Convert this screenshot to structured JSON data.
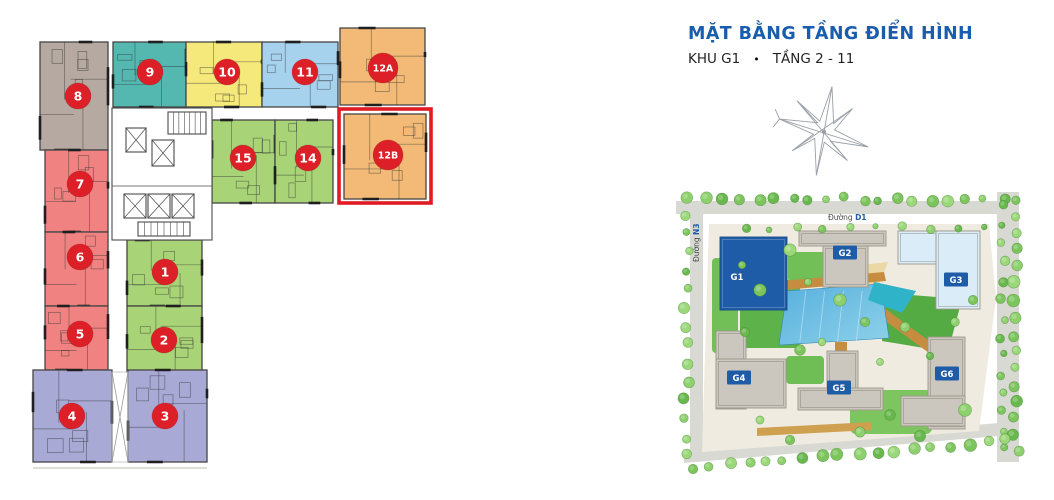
{
  "header": {
    "title": "MẶT BẰNG TẦNG ĐIỂN HÌNH",
    "subtitle_block": "KHU G1",
    "subtitle_bullet": "•",
    "subtitle_floors": "TẦNG 2 - 11",
    "title_color": "#1a5dad"
  },
  "floor_plan": {
    "badge_color": "#dd2027",
    "badge_text_color": "#ffffff",
    "wall_color": "#454545",
    "highlight": {
      "unit": "12B",
      "color": "#e01b23",
      "x": 339,
      "y": 109,
      "w": 92,
      "h": 94
    },
    "units": [
      {
        "id": "8",
        "color": "#b5a9a1",
        "x": 40,
        "y": 42,
        "w": 68,
        "h": 108,
        "bx": 78,
        "by": 96
      },
      {
        "id": "9",
        "color": "#55b8b0",
        "x": 113,
        "y": 42,
        "w": 73,
        "h": 65,
        "bx": 150,
        "by": 72
      },
      {
        "id": "10",
        "color": "#f5e97c",
        "x": 186,
        "y": 42,
        "w": 76,
        "h": 65,
        "bx": 227,
        "by": 72
      },
      {
        "id": "11",
        "color": "#a7d2ee",
        "x": 262,
        "y": 42,
        "w": 76,
        "h": 65,
        "bx": 305,
        "by": 72
      },
      {
        "id": "12A",
        "color": "#f2ba76",
        "x": 340,
        "y": 28,
        "w": 85,
        "h": 77,
        "bx": 383,
        "by": 68
      },
      {
        "id": "15",
        "color": "#a8d377",
        "x": 212,
        "y": 120,
        "w": 63,
        "h": 83,
        "bx": 243,
        "by": 158
      },
      {
        "id": "14",
        "color": "#a8d377",
        "x": 275,
        "y": 120,
        "w": 58,
        "h": 83,
        "bx": 308,
        "by": 158
      },
      {
        "id": "12B",
        "color": "#f2ba76",
        "x": 344,
        "y": 114,
        "w": 82,
        "h": 85,
        "bx": 388,
        "by": 155
      },
      {
        "id": "7",
        "color": "#f08381",
        "x": 45,
        "y": 150,
        "w": 63,
        "h": 82,
        "bx": 80,
        "by": 184
      },
      {
        "id": "6",
        "color": "#f08381",
        "x": 45,
        "y": 232,
        "w": 63,
        "h": 74,
        "bx": 80,
        "by": 257
      },
      {
        "id": "5",
        "color": "#f08381",
        "x": 45,
        "y": 306,
        "w": 63,
        "h": 64,
        "bx": 80,
        "by": 334
      },
      {
        "id": "1",
        "color": "#a8d377",
        "x": 127,
        "y": 240,
        "w": 75,
        "h": 66,
        "bx": 165,
        "by": 272
      },
      {
        "id": "2",
        "color": "#a8d377",
        "x": 127,
        "y": 306,
        "w": 75,
        "h": 66,
        "bx": 164,
        "by": 340
      },
      {
        "id": "4",
        "color": "#a9a9d6",
        "x": 33,
        "y": 370,
        "w": 79,
        "h": 92,
        "bx": 72,
        "by": 416
      },
      {
        "id": "3",
        "color": "#a9a9d6",
        "x": 128,
        "y": 370,
        "w": 79,
        "h": 92,
        "bx": 165,
        "by": 416
      }
    ]
  },
  "site_plan": {
    "chip_color": "#1f5ca7",
    "chip_text_color": "#ffffff",
    "road_label_top_prefix": "Đường",
    "road_label_top_bold": "D1",
    "road_label_left_prefix": "Đường",
    "road_label_left_bold": "N3",
    "buildings": [
      {
        "id": "G1",
        "label": "G1",
        "highlighted": true,
        "fill": "#1f5ca7",
        "rects": [
          [
            720,
            237,
            67,
            73
          ]
        ],
        "label_pos": [
          737,
          277
        ],
        "chip": false
      },
      {
        "id": "G2",
        "label": "G2",
        "highlighted": false,
        "fill": "#cbc7bf",
        "rects": [
          [
            799,
            231,
            87,
            15
          ],
          [
            823,
            246,
            45,
            41
          ]
        ],
        "label_pos": [
          845,
          253
        ],
        "chip": true
      },
      {
        "id": "G3",
        "label": "G3",
        "highlighted": false,
        "fill": "#d9ecf7",
        "rects": [
          [
            898,
            231,
            80,
            33
          ],
          [
            936,
            231,
            44,
            78
          ]
        ],
        "label_pos": [
          956,
          280
        ],
        "chip": true
      },
      {
        "id": "G4",
        "label": "G4",
        "highlighted": false,
        "fill": "#cbc7bf",
        "rects": [
          [
            716,
            331,
            30,
            78
          ],
          [
            716,
            359,
            70,
            49
          ]
        ],
        "label_pos": [
          739,
          378
        ],
        "chip": true
      },
      {
        "id": "G5",
        "label": "G5",
        "highlighted": false,
        "fill": "#cbc7bf",
        "rects": [
          [
            827,
            351,
            31,
            42
          ],
          [
            798,
            388,
            85,
            22
          ]
        ],
        "label_pos": [
          839,
          388
        ],
        "chip": true
      },
      {
        "id": "G6",
        "label": "G6",
        "highlighted": false,
        "fill": "#cbc7bf",
        "rects": [
          [
            928,
            337,
            37,
            92
          ],
          [
            901,
            396,
            64,
            30
          ]
        ],
        "label_pos": [
          947,
          374
        ],
        "chip": true
      }
    ]
  }
}
